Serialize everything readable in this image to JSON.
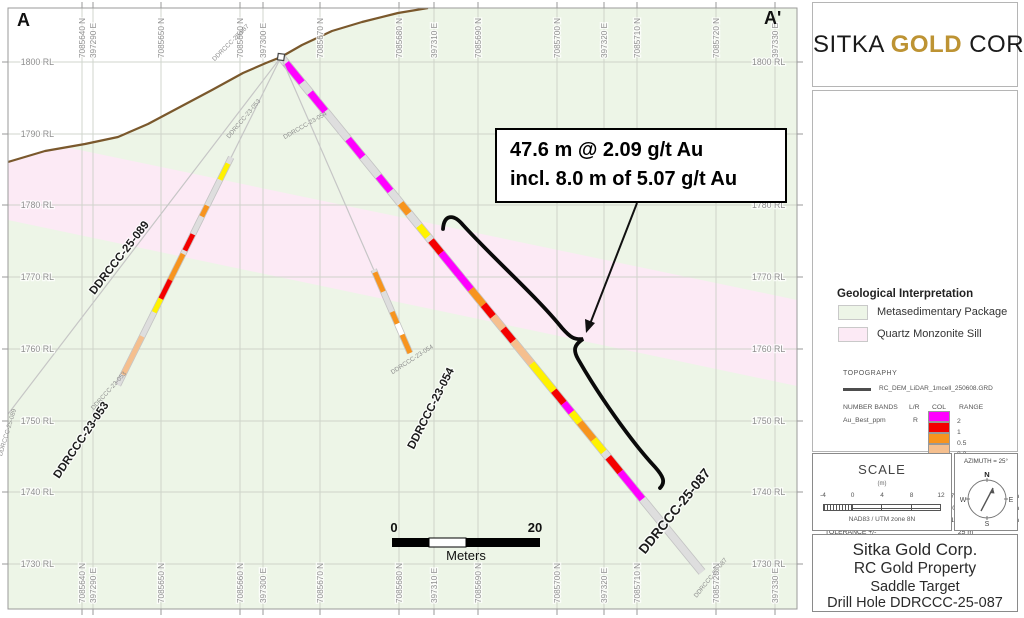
{
  "corners": {
    "left": "A",
    "right": "A'"
  },
  "logo": {
    "word1": "SITKA",
    "word2": "GOLD",
    "word3": "CORP"
  },
  "annotation": {
    "line1": "47.6 m @ 2.09 g/t Au",
    "line2": "incl. 8.0 m of 5.07 g/t Au"
  },
  "legend": {
    "title": "Geological Interpretation",
    "items": [
      {
        "label": "Metasedimentary Package",
        "color": "#edf5e7"
      },
      {
        "label": "Quartz Monzonite Sill",
        "color": "#fceaf5"
      }
    ],
    "topography_label": "TOPOGRAPHY",
    "topography_file": "RC_DEM_LiDAR_1mcell_250608.GRD"
  },
  "number_bands": {
    "header": {
      "c1": "NUMBER BANDS",
      "c2": "L/R",
      "c3": "COL",
      "c4": "RANGE"
    },
    "series": "Au_Best_ppm",
    "lr": "R",
    "bands": [
      "#ff00ff",
      "#f40000",
      "#f7941e",
      "#f5bf8e",
      "#fff200",
      "#d9d9d9"
    ],
    "boundaries": [
      "2",
      "1",
      "0.5",
      "0.3",
      "0.1"
    ]
  },
  "section_specs": {
    "title": "SECTION SPECS:",
    "rows": [
      {
        "label": "REF. PT. E, N",
        "v1": "397308 m",
        "v2": "7085680 m"
      },
      {
        "label": "EXTENTS",
        "v1": "109.8 m",
        "v2": "84.76 m"
      },
      {
        "label": "SECTION TOP, BOT",
        "v1": "1808 m",
        "v2": "1724 m"
      },
      {
        "label": "TOLERANCE +/-",
        "v1": "25 m",
        "v2": ""
      }
    ]
  },
  "scale_box": {
    "title": "SCALE",
    "units_label": "(m)",
    "ticks": [
      "-4",
      "0",
      "4",
      "8",
      "12"
    ],
    "datum": "NAD83 / UTM zone 8N"
  },
  "azimuth_box": {
    "label": "AZIMUTH = 25°",
    "n": "N",
    "e": "E",
    "s": "S",
    "w": "W"
  },
  "title_block": {
    "line1": "Sitka Gold Corp.",
    "line2": "RC Gold Property",
    "line3": "Saddle Target",
    "line4": "Drill Hole DDRCCC-25-087"
  },
  "map": {
    "frame": {
      "x": 8,
      "y": 8,
      "w": 789,
      "h": 601
    },
    "colors": {
      "metased": "#edf5e7",
      "sill": "#fceaf5",
      "grid": "#c9cfc6",
      "frame": "#9a9a9a",
      "topo": "#7a582c",
      "axis_text": "#8f8f8f",
      "hole_base": "#dedede",
      "hole_outline": "#c2c2c2",
      "thin_line": "#c6c6c6"
    },
    "topography": [
      [
        8,
        162
      ],
      [
        45,
        151
      ],
      [
        85,
        144
      ],
      [
        118,
        137
      ],
      [
        148,
        124
      ],
      [
        180,
        107
      ],
      [
        212,
        90
      ],
      [
        243,
        73
      ],
      [
        266,
        63
      ],
      [
        281,
        57
      ],
      [
        302,
        45
      ],
      [
        332,
        31
      ],
      [
        362,
        22
      ],
      [
        398,
        13
      ],
      [
        428,
        8
      ]
    ],
    "sill": {
      "top": [
        [
          8,
          163
        ],
        [
          45,
          152
        ],
        [
          70,
          148
        ],
        [
          797,
          300
        ]
      ],
      "bottom_right": [
        797,
        386
      ],
      "bottom_left": [
        8,
        220
      ]
    },
    "columns": [
      {
        "x": 82,
        "label": "7085640 N"
      },
      {
        "x": 93,
        "label": "397290 E"
      },
      {
        "x": 161,
        "label": "7085650 N"
      },
      {
        "x": 240,
        "label": "7085660 N"
      },
      {
        "x": 263,
        "label": "397300 E"
      },
      {
        "x": 320,
        "label": "7085670 N"
      },
      {
        "x": 399,
        "label": "7085680 N"
      },
      {
        "x": 434,
        "label": "397310 E"
      },
      {
        "x": 478,
        "label": "7085690 N"
      },
      {
        "x": 557,
        "label": "7085700 N"
      },
      {
        "x": 604,
        "label": "397320 E"
      },
      {
        "x": 637,
        "label": "7085710 N"
      },
      {
        "x": 716,
        "label": "7085720 N"
      },
      {
        "x": 775,
        "label": "397330 E"
      }
    ],
    "rows": [
      {
        "y": 62,
        "label": "1800 RL"
      },
      {
        "y": 134,
        "label": "1790 RL"
      },
      {
        "y": 205,
        "label": "1780 RL"
      },
      {
        "y": 277,
        "label": "1770 RL"
      },
      {
        "y": 349,
        "label": "1760 RL"
      },
      {
        "y": 421,
        "label": "1750 RL"
      },
      {
        "y": 492,
        "label": "1740 RL"
      },
      {
        "y": 564,
        "label": "1730 RL"
      }
    ],
    "interval_colors": {
      "magenta": "#ff00ff",
      "red": "#f40000",
      "orange": "#f7941e",
      "peach": "#f5bf8e",
      "yellow": "#fff200",
      "white": "#ffffff"
    },
    "holes": [
      {
        "id": "DDRCCC-25-087",
        "from": [
          281,
          57
        ],
        "to": [
          702,
          572
        ],
        "width": 7,
        "thick_from": 0,
        "segments": [
          [
            8,
            33,
            "magenta"
          ],
          [
            46,
            70,
            "magenta"
          ],
          [
            106,
            129,
            "magenta"
          ],
          [
            154,
            173,
            "magenta"
          ],
          [
            189,
            202,
            "orange"
          ],
          [
            218,
            232,
            "yellow"
          ],
          [
            237,
            253,
            "red"
          ],
          [
            253,
            300,
            "magenta"
          ],
          [
            300,
            320,
            "orange"
          ],
          [
            320,
            335,
            "red"
          ],
          [
            335,
            351,
            "peach"
          ],
          [
            351,
            367,
            "red"
          ],
          [
            367,
            396,
            "peach"
          ],
          [
            396,
            431,
            "yellow"
          ],
          [
            431,
            447,
            "red"
          ],
          [
            447,
            459,
            "magenta"
          ],
          [
            459,
            472,
            "yellow"
          ],
          [
            472,
            494,
            "orange"
          ],
          [
            494,
            510,
            "yellow"
          ],
          [
            517,
            536,
            "red"
          ],
          [
            536,
            571,
            "magenta"
          ]
        ]
      },
      {
        "id": "DDRCCC-23-053",
        "from": [
          281,
          57
        ],
        "to": [
          118,
          385
        ],
        "width": 5,
        "thick_from": 112,
        "segments": [
          [
            119,
            137,
            "yellow"
          ],
          [
            166,
            178,
            "orange"
          ],
          [
            198,
            216,
            "red"
          ],
          [
            220,
            249,
            "orange"
          ],
          [
            249,
            270,
            "red"
          ],
          [
            270,
            285,
            "yellow"
          ],
          [
            312,
            355,
            "peach"
          ]
        ]
      },
      {
        "id": "DDRCCC-23-054",
        "from": [
          281,
          57
        ],
        "to": [
          410,
          353
        ],
        "width": 5,
        "thick_from": 232,
        "segments": [
          [
            235,
            256,
            "orange"
          ],
          [
            278,
            291,
            "orange"
          ],
          [
            291,
            303,
            "white"
          ],
          [
            303,
            323,
            "orange"
          ]
        ]
      },
      {
        "id": "DDRCCC-25-089",
        "from": [
          281,
          57
        ],
        "to": [
          5,
          418
        ],
        "width": 0,
        "thick_from": 9999,
        "segments": []
      }
    ],
    "collar": {
      "x": 281,
      "y": 57
    },
    "labels_big": [
      {
        "text": "DDRCCC-25-089",
        "x": 122,
        "y": 260,
        "rot": -52,
        "size": 11.5
      },
      {
        "text": "DDRCCC-23-053",
        "x": 84,
        "y": 442,
        "rot": -56,
        "size": 11.5
      },
      {
        "text": "DDRCCC-23-054",
        "x": 434,
        "y": 410,
        "rot": -63,
        "size": 11.5
      },
      {
        "text": "DDRCCC-25-087",
        "x": 678,
        "y": 514,
        "rot": -51,
        "size": 13.5,
        "bold": true
      }
    ],
    "labels_small": [
      {
        "text": "DDRCCC-25-087",
        "x": 232,
        "y": 44,
        "rot": -45
      },
      {
        "text": "DDRCCC-23-053",
        "x": 245,
        "y": 120,
        "rot": -50
      },
      {
        "text": "DDRCCC-23-054",
        "x": 306,
        "y": 127,
        "rot": -30
      },
      {
        "text": "DDRCCC-23-053",
        "x": 110,
        "y": 392,
        "rot": -48
      },
      {
        "text": "DDRCCC-23-054",
        "x": 413,
        "y": 361,
        "rot": -33
      },
      {
        "text": "DDRCCC-25-087",
        "x": 712,
        "y": 579,
        "rot": -51
      },
      {
        "text": "DDRCCC-25-089",
        "x": 9,
        "y": 433,
        "rot": -73
      }
    ],
    "scalebar": {
      "x": 392,
      "y": 538,
      "seg": 37,
      "h": 9,
      "start_label": "0",
      "end_label": "20",
      "units": "Meters"
    }
  }
}
